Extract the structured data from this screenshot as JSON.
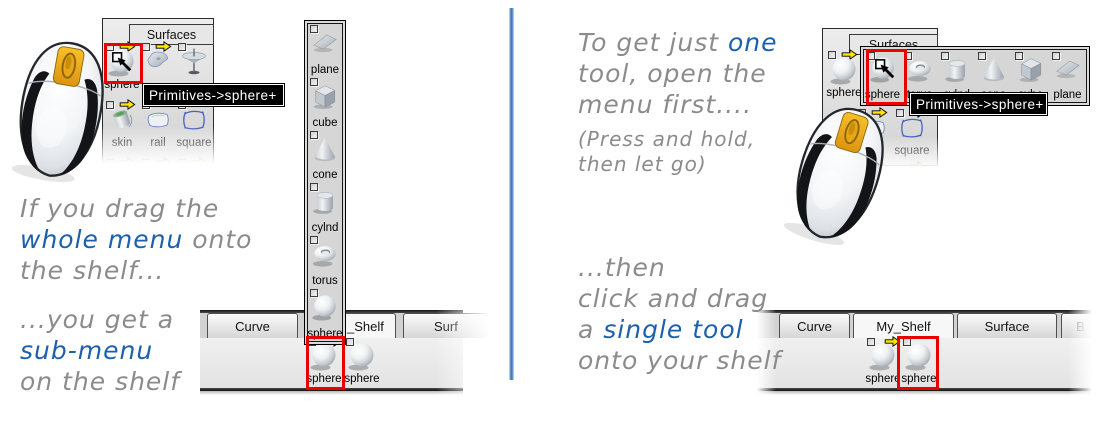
{
  "colors": {
    "annotation_red": "#e90000",
    "arrow_yellow": "#ffe600",
    "divider_blue": "#3a6fb2",
    "caption_gray": "#8b8b8b",
    "caption_blue": "#1b5fad"
  },
  "tooltip": {
    "text": "Primitives->sphere",
    "plus": "+"
  },
  "left": {
    "caption_top": {
      "l1": "If you drag the",
      "em": "whole menu",
      "l2_rest": " onto",
      "l3": "the shelf..."
    },
    "caption_bottom": {
      "l1": "...you get a",
      "em": "sub-menu",
      "l3": "on the shelf"
    },
    "panel": {
      "title": "Surfaces",
      "row1": [
        {
          "label": "sphere",
          "icon": "sphere"
        },
        {
          "label": "",
          "icon": "loft"
        },
        {
          "label": "",
          "icon": "revolve"
        }
      ],
      "row2": [
        {
          "label": "skin",
          "icon": "skin"
        },
        {
          "label": "rail",
          "icon": "rail"
        },
        {
          "label": "square",
          "icon": "square"
        }
      ]
    },
    "menu": {
      "items": [
        {
          "label": "plane",
          "icon": "plane"
        },
        {
          "label": "cube",
          "icon": "cube"
        },
        {
          "label": "cone",
          "icon": "cone"
        },
        {
          "label": "cylnd",
          "icon": "cylnd"
        },
        {
          "label": "torus",
          "icon": "torus"
        },
        {
          "label": "sphere",
          "icon": "sphere"
        }
      ]
    },
    "shelf": {
      "tabs": [
        {
          "label": "Curve"
        },
        {
          "label": "_Shelf"
        },
        {
          "label": "Surf"
        }
      ],
      "items": [
        {
          "label": "sphere"
        },
        {
          "label": "sphere"
        }
      ]
    }
  },
  "right": {
    "caption_top": {
      "l1_pre": "To get just ",
      "em": "one",
      "l2": "tool, open the",
      "l3": "menu first....",
      "note1": "(Press and hold,",
      "note2": "then let go)"
    },
    "caption_bottom": {
      "l1": "...then",
      "l2": "click and drag",
      "l3_pre": "a ",
      "em": "single tool",
      "l4": "onto your shelf"
    },
    "panel": {
      "title": "Surfaces",
      "row1": [
        {
          "label": "sphere",
          "icon": "sphere"
        }
      ],
      "row2": [
        {
          "label": "rail",
          "icon": "rail"
        },
        {
          "label": "square",
          "icon": "square"
        }
      ]
    },
    "menu": {
      "items": [
        {
          "label": "sphere",
          "icon": "sphere"
        },
        {
          "label": "torus",
          "icon": "torus"
        },
        {
          "label": "cylnd",
          "icon": "cylnd"
        },
        {
          "label": "cone",
          "icon": "cone"
        },
        {
          "label": "cube",
          "icon": "cube"
        },
        {
          "label": "plane",
          "icon": "plane"
        }
      ]
    },
    "shelf": {
      "tabs": [
        {
          "label": "Curve"
        },
        {
          "label": "My_Shelf"
        },
        {
          "label": "Surface"
        },
        {
          "label": "B"
        }
      ],
      "items": [
        {
          "label": "sphere"
        },
        {
          "label": "sphere"
        }
      ]
    }
  }
}
